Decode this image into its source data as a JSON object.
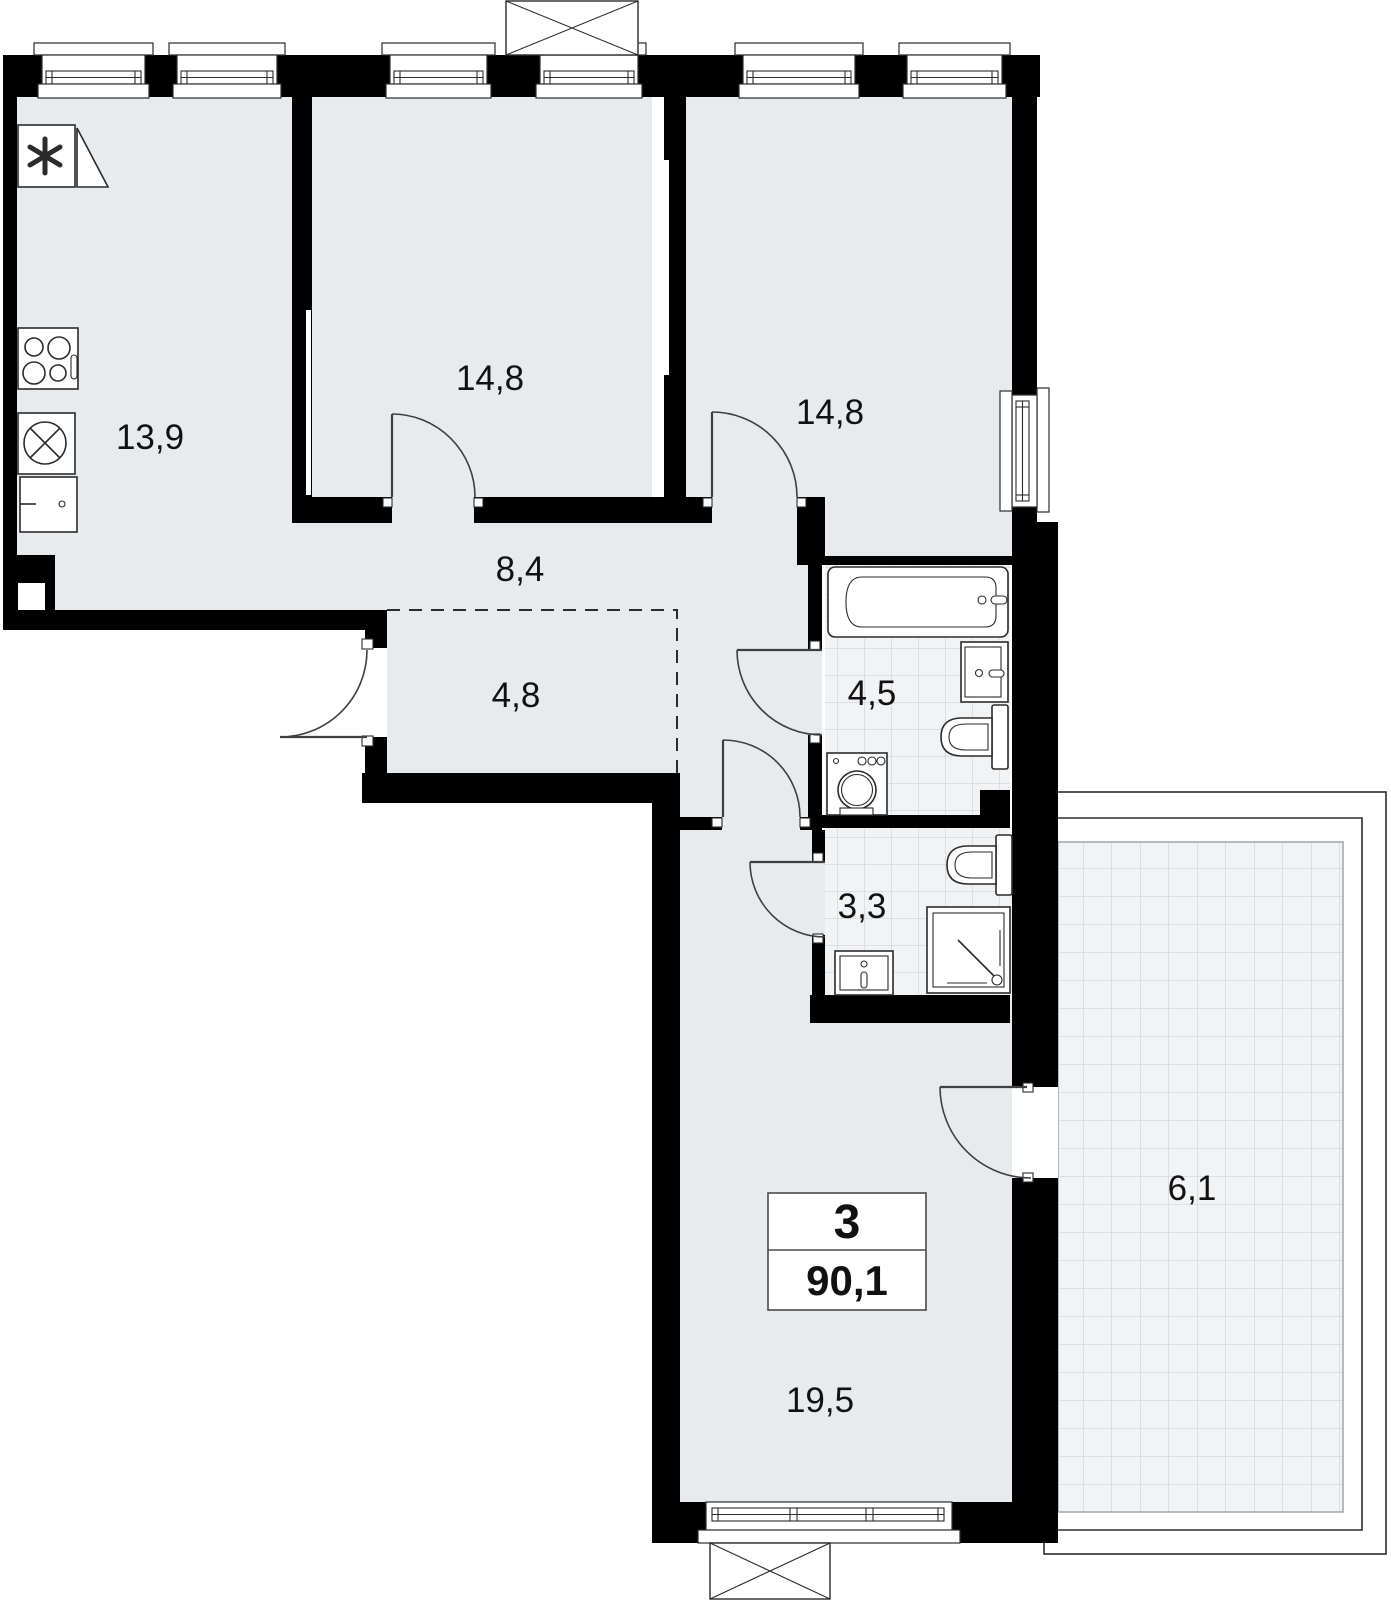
{
  "plan": {
    "apartment": {
      "rooms_count": "3",
      "total_area": "90,1"
    },
    "rooms": {
      "kitchen": {
        "label": "13,9"
      },
      "bedroom1": {
        "label": "14,8"
      },
      "bedroom2": {
        "label": "14,8"
      },
      "hallway": {
        "label": "8,4"
      },
      "wardrobe": {
        "label": "4,8"
      },
      "bathroom": {
        "label": "4,5"
      },
      "wc": {
        "label": "3,3"
      },
      "living_room": {
        "label": "19,5"
      },
      "balcony": {
        "label": "6,1"
      }
    },
    "colors": {
      "wall": "#000000",
      "floor": "#e8ebee",
      "tile_floor": "#f1f3f5",
      "tile_grid": "#c6ccd2",
      "fixture_stroke": "#2b2b2b"
    }
  }
}
